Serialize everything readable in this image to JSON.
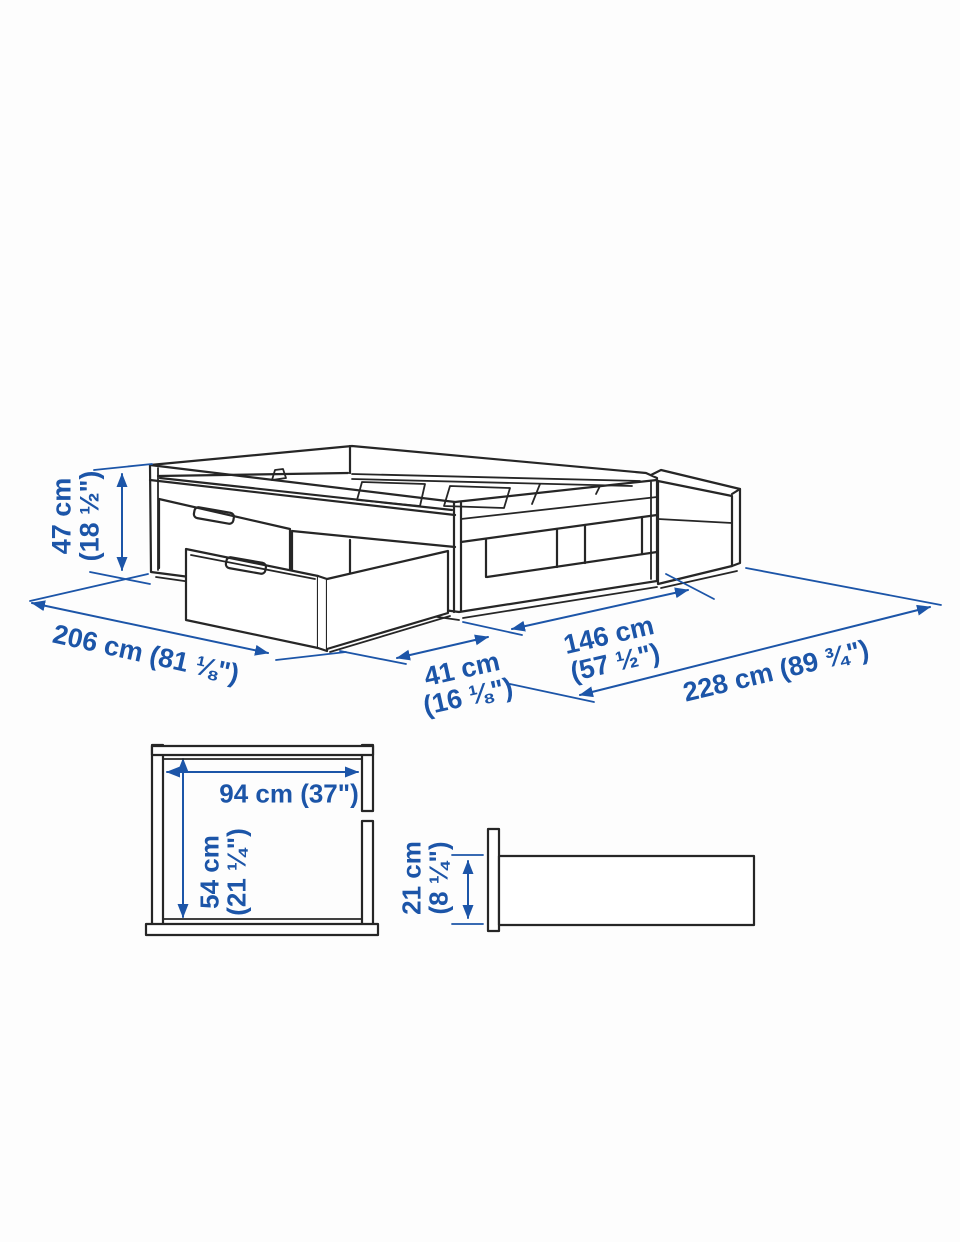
{
  "colors": {
    "dimension_blue": "#1c55a8",
    "line_dark": "#262626",
    "background": "#fdfdfd"
  },
  "diagram": {
    "labels": {
      "height47": {
        "line1": "47 cm",
        "line2": "(18 ½\")"
      },
      "length206": {
        "text": "206 cm (81 ⅛\")"
      },
      "drawer41": {
        "line1": "41 cm",
        "line2": "(16 ⅛\")"
      },
      "width146": {
        "line1": "146 cm",
        "line2": "(57 ½\")"
      },
      "total228": {
        "text": "228 cm (89 ¾\")"
      },
      "inner94": {
        "text": "94 cm (37\")"
      },
      "inner54": {
        "line1": "54 cm",
        "line2": "(21 ¼\")"
      },
      "inner21": {
        "line1": "21 cm",
        "line2": "(8 ¼\")"
      }
    }
  }
}
